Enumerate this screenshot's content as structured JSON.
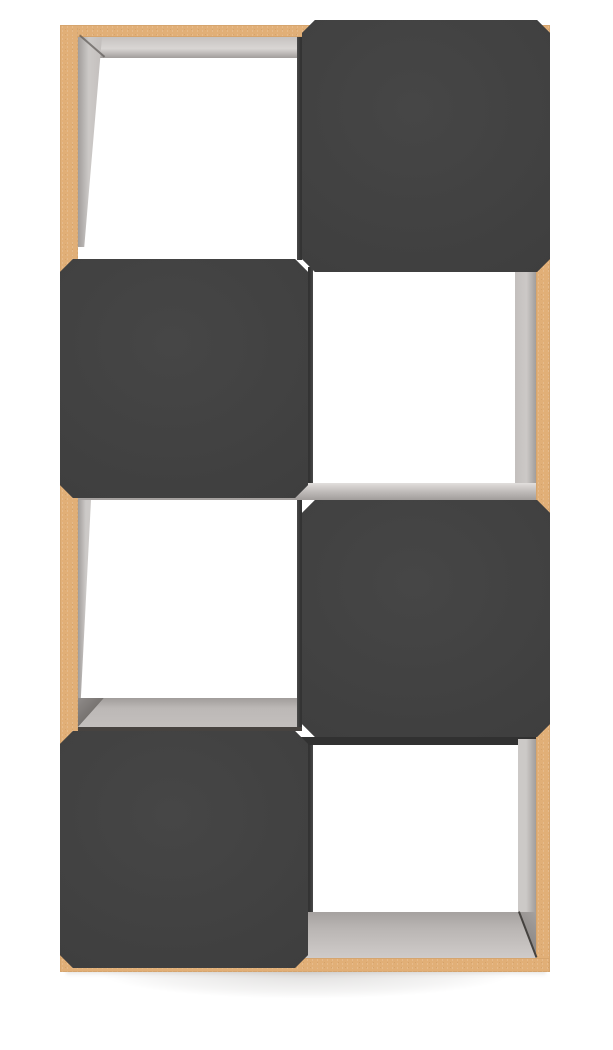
{
  "meta": {
    "title": "Product photo - four-tier cube storage organizer",
    "description": "Studio product photo on a white background: an eight-cube (4 rows x 2 columns) storage organizer with a natural tan particleboard frame, light gray woodgrain interior surfaces, and dark charcoal front panels with chamfered corners arranged in a checkerboard pattern; a soft shadow sits beneath the unit."
  },
  "product": {
    "kind": "cube-storage-organizer",
    "rows": 4,
    "columns": 2,
    "pattern": [
      [
        "open",
        "panel"
      ],
      [
        "panel",
        "open"
      ],
      [
        "open",
        "panel"
      ],
      [
        "panel",
        "open"
      ]
    ],
    "panel_corner_style": "chamfered",
    "open_cube_labels": [
      "row1-left",
      "row2-right",
      "row3-left",
      "row4-right"
    ],
    "dark_panel_labels": [
      "row1-right",
      "row2-left",
      "row3-right",
      "row4-left"
    ]
  },
  "colors": {
    "background": "#ffffff",
    "frame_tan": "#e1af77",
    "frame_tan_light": "#ecc694",
    "frame_tan_dark_a": "rgba(150,100,50,0.16)",
    "panel_dark": "#3e3e3e",
    "panel_dark_light": "#464646",
    "panel_dark_deep": "#363636",
    "wood_gray": "#c3bfbd",
    "wood_gray_light": "#d9d6d4",
    "wood_gray_dark": "#a19d9b",
    "crease_dark": "#55504d",
    "divider_shadow": "#333333",
    "shadow_strong": "rgba(80,75,70,0.18)"
  }
}
